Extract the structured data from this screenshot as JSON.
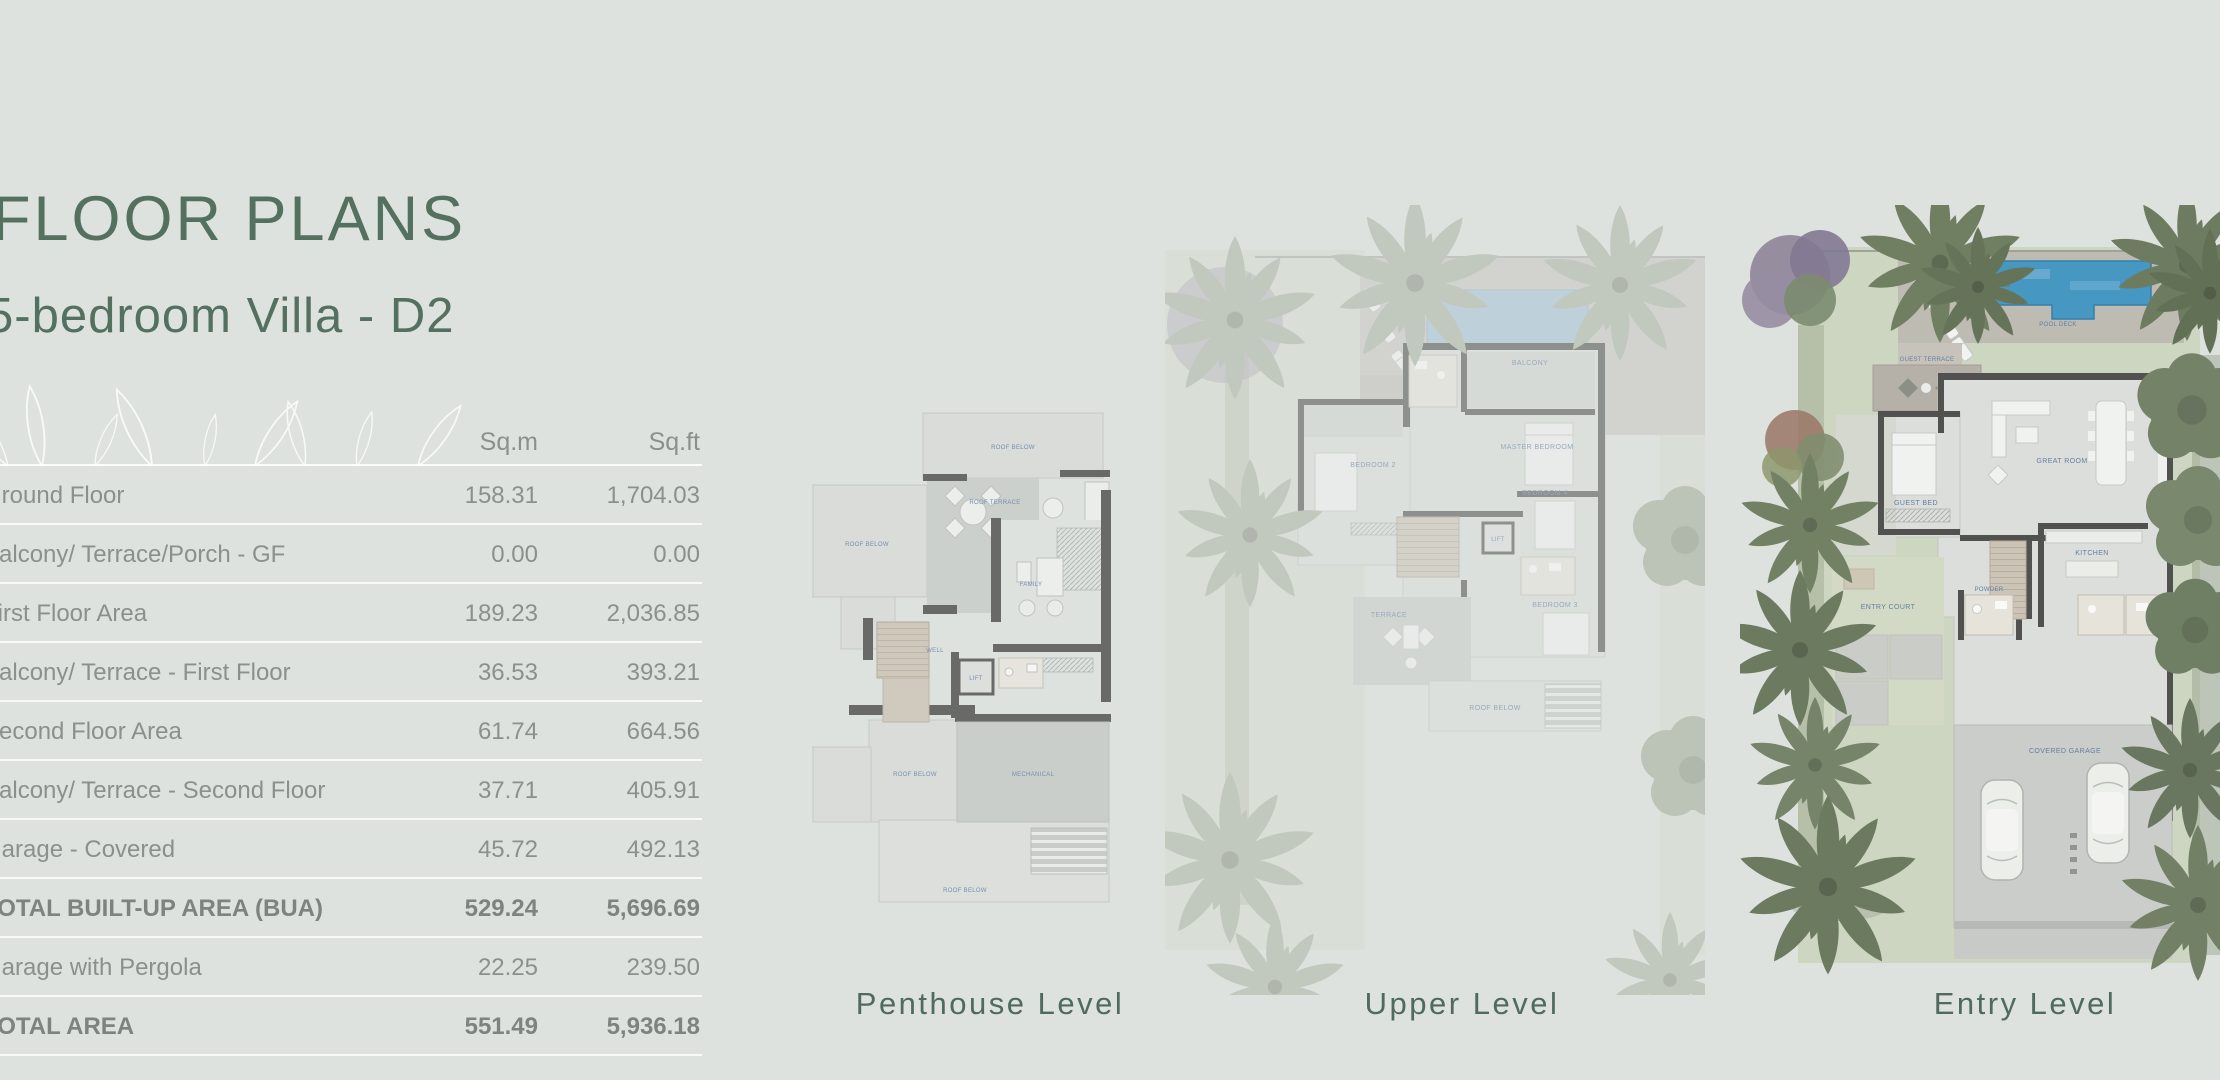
{
  "page": {
    "title": "FLOOR PLANS",
    "subtitle": "5-bedroom Villa - D2",
    "background_color": "#dee2df",
    "accent_color": "#54705f"
  },
  "area_table": {
    "columns": [
      "Sq.m",
      "Sq.ft"
    ],
    "rows": [
      {
        "label": "Ground Floor",
        "sqm": "158.31",
        "sqft": "1,704.03",
        "emphasis": false
      },
      {
        "label": "Balcony/ Terrace/Porch - GF",
        "sqm": "0.00",
        "sqft": "0.00",
        "emphasis": false
      },
      {
        "label": "First Floor Area",
        "sqm": "189.23",
        "sqft": "2,036.85",
        "emphasis": false
      },
      {
        "label": "Balcony/ Terrace - First Floor",
        "sqm": "36.53",
        "sqft": "393.21",
        "emphasis": false
      },
      {
        "label": "Second Floor Area",
        "sqm": "61.74",
        "sqft": "664.56",
        "emphasis": false
      },
      {
        "label": "Balcony/ Terrace - Second Floor",
        "sqm": "37.71",
        "sqft": "405.91",
        "emphasis": false
      },
      {
        "label": "Garage - Covered",
        "sqm": "45.72",
        "sqft": "492.13",
        "emphasis": false
      },
      {
        "label": "TOTAL BUILT-UP AREA (BUA)",
        "sqm": "529.24",
        "sqft": "5,696.69",
        "emphasis": true
      },
      {
        "label": "Garage with Pergola",
        "sqm": "22.25",
        "sqft": "239.50",
        "emphasis": false
      },
      {
        "label": "TOTAL AREA",
        "sqm": "551.49",
        "sqft": "5,936.18",
        "emphasis": true
      }
    ]
  },
  "plans": {
    "captions": [
      {
        "label": "Penthouse Level"
      },
      {
        "label": "Upper Level"
      },
      {
        "label": "Entry Level"
      }
    ],
    "room_labels": {
      "roof_below": "ROOF BELOW",
      "roof_terrace": "ROOF TERRACE",
      "family": "FAMILY",
      "well": "WELL",
      "lift": "LIFT",
      "bath": "BATH",
      "mechanical": "MECHANICAL",
      "balcony": "BALCONY",
      "master_bedroom": "MASTER BEDROOM",
      "bedroom_2": "BEDROOM 2",
      "bedroom_3": "BEDROOM 3",
      "bedroom_4": "BEDROOM 4",
      "terrace": "TERRACE",
      "guest_terrace": "GUEST TERRACE",
      "guest_bed": "GUEST BED",
      "great_room": "GREAT ROOM",
      "kitchen": "KITCHEN",
      "entry_court": "ENTRY COURT",
      "covered_garage": "COVERED GARAGE",
      "pool_deck": "POOL DECK",
      "powder": "POWDER"
    }
  }
}
